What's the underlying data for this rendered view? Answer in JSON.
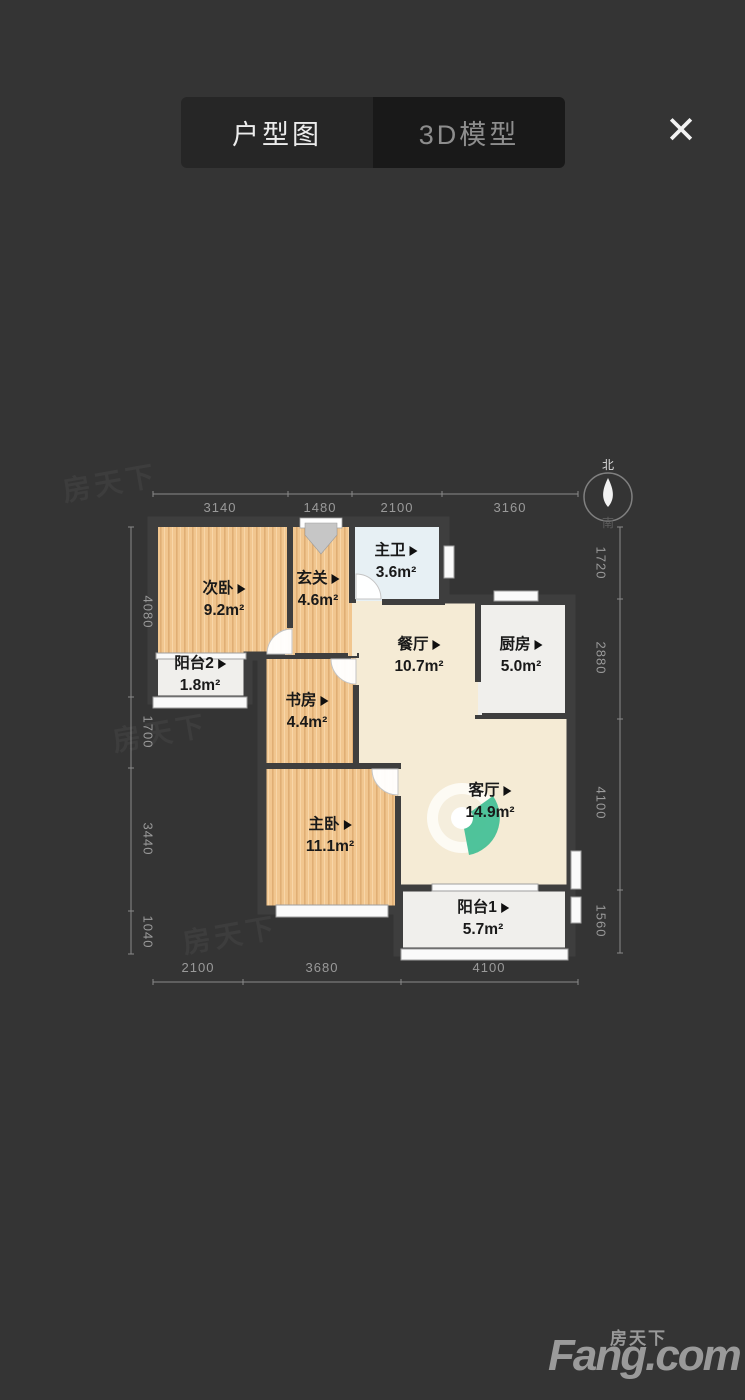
{
  "header": {
    "tabs": [
      {
        "label": "户型图",
        "active": true
      },
      {
        "label": "3D模型",
        "active": false
      }
    ]
  },
  "icons": {
    "close": "✕"
  },
  "floorplan": {
    "compass": {
      "north": "北",
      "south": "南"
    },
    "rooms": [
      {
        "name": "次卧",
        "area": "9.2m²"
      },
      {
        "name": "玄关",
        "area": "4.6m²"
      },
      {
        "name": "主卫",
        "area": "3.6m²"
      },
      {
        "name": "餐厅",
        "area": "10.7m²"
      },
      {
        "name": "厨房",
        "area": "5.0m²"
      },
      {
        "name": "阳台2",
        "area": "1.8m²"
      },
      {
        "name": "书房",
        "area": "4.4m²"
      },
      {
        "name": "主卧",
        "area": "11.1m²"
      },
      {
        "name": "客厅",
        "area": "14.9m²"
      },
      {
        "name": "阳台1",
        "area": "5.7m²"
      }
    ],
    "dimensions": {
      "top": [
        "3140",
        "1480",
        "2100",
        "3160"
      ],
      "bottom": [
        "2100",
        "3680",
        "4100"
      ],
      "left": [
        "4080",
        "1700",
        "3440",
        "1040"
      ],
      "right": [
        "1720",
        "2880",
        "4100",
        "1560"
      ]
    }
  },
  "watermark": {
    "text": "房天下"
  },
  "logo": {
    "cn": "房天下",
    "en": "Fang.com"
  },
  "colors": {
    "background": "#343434",
    "wall": "#3e3e3e",
    "wood": "#f1c68f",
    "dining_floor": "#f5ebd5",
    "bath_floor": "#e7f0f4",
    "utility_floor": "#f0efec",
    "accent_green": "#46c096",
    "dim_text": "#9a9a9a"
  }
}
